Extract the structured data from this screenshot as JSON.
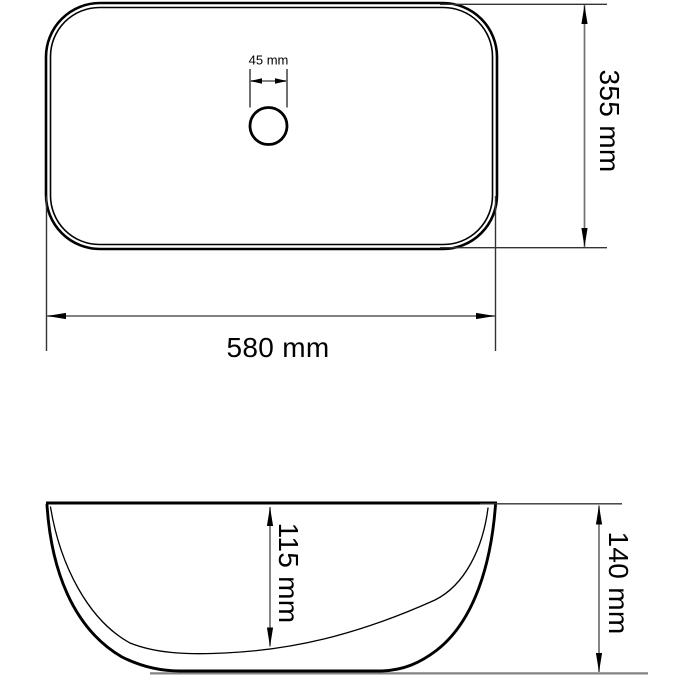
{
  "colors": {
    "line": "#000000",
    "extension": "#333333",
    "dimension": "#707070",
    "ground": "#848484",
    "background": "#ffffff"
  },
  "views": {
    "top": {
      "dimensions": {
        "drain_diameter": {
          "label": "45 mm",
          "value": 45,
          "unit": "mm"
        },
        "width": {
          "label": "580 mm",
          "value": 580,
          "unit": "mm"
        },
        "depth": {
          "label": "355 mm",
          "value": 355,
          "unit": "mm"
        }
      }
    },
    "side": {
      "dimensions": {
        "bowl_depth": {
          "label": "115 mm",
          "value": 115,
          "unit": "mm"
        },
        "total_height": {
          "label": "140 mm",
          "value": 140,
          "unit": "mm"
        }
      }
    }
  }
}
